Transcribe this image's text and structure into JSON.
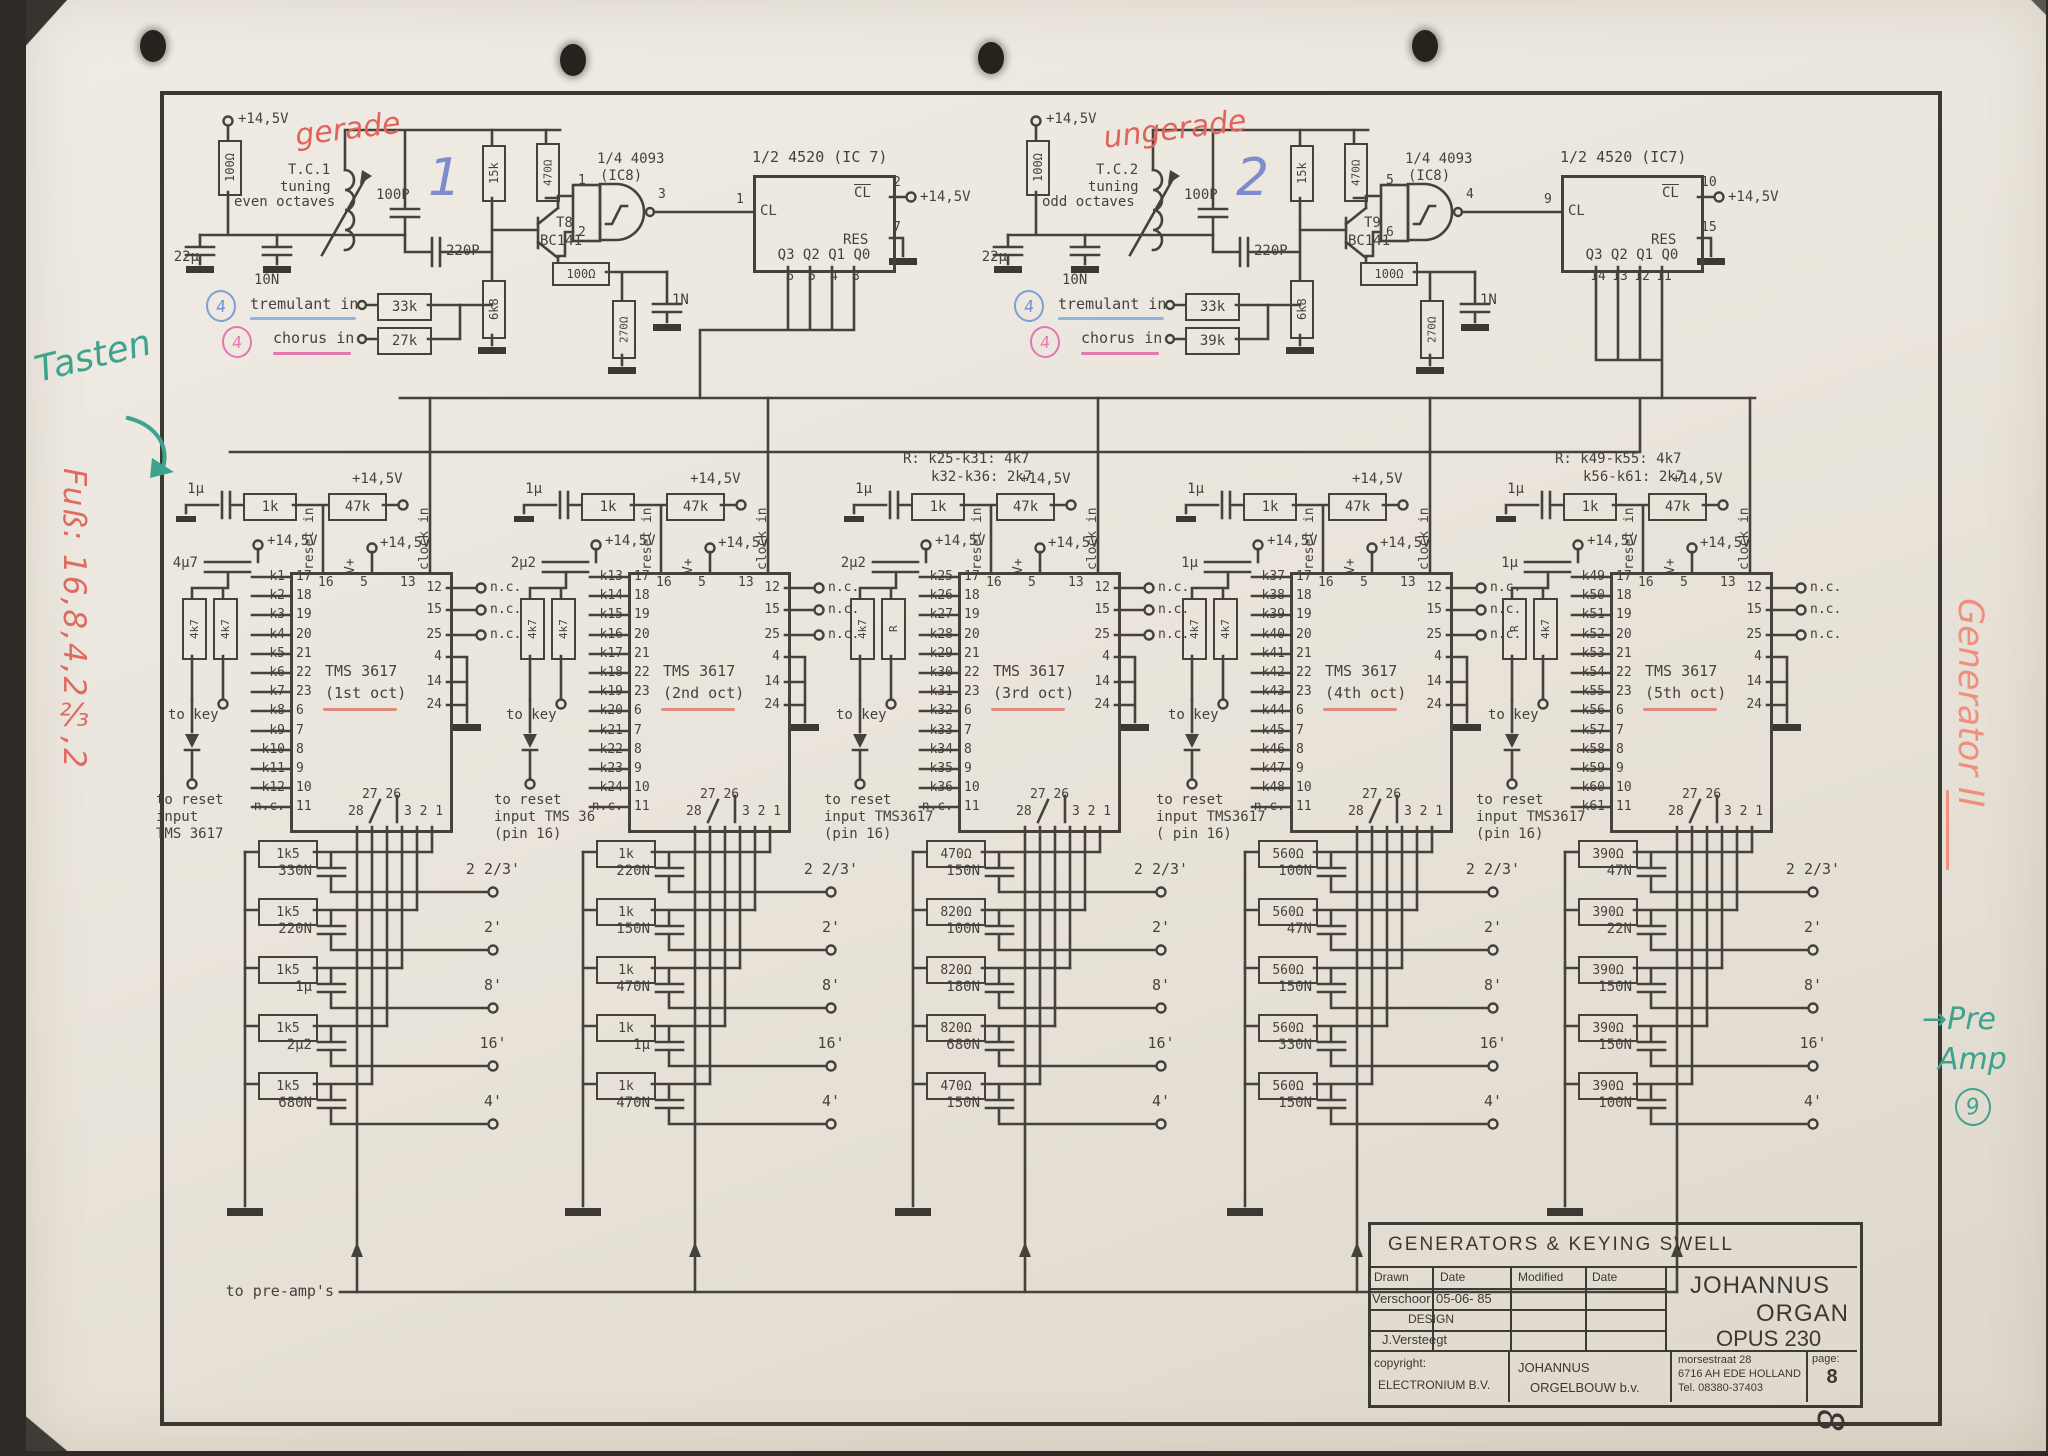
{
  "osc": [
    {
      "supply": "+14,5V",
      "r_top": "100Ω",
      "c_el": "22µ",
      "c_small": "10N",
      "tc": "T.C.1",
      "tuning_l1": "tuning",
      "tuning_l2": "even octaves",
      "hand_word": "gerade",
      "hand_num": "1",
      "c_tune": "100P",
      "c_fb": "220P",
      "r_15k": "15k",
      "r_470": "470Ω",
      "r_6k8": "6k8",
      "q_name": "T8",
      "q_type": "BC141",
      "r_100": "100Ω",
      "r_270": "270Ω",
      "c_1n": "1N",
      "gate_name": "1/4 4093",
      "gate_ic": "(IC8)",
      "gate_in1": "1",
      "gate_in2": "2",
      "gate_out": "3",
      "cnt_name": "1/2 4520 (IC 7)",
      "cnt_supply": "+14,5V",
      "cnt_cl": "CL",
      "cnt_cl_pin": "1",
      "cnt_clb": "CL",
      "cnt_clb_pin": "2",
      "cnt_res": "RES",
      "cnt_res_pin": "7",
      "cnt_q": "Q3 Q2 Q1 Q0",
      "qp": [
        "6",
        "5",
        "4",
        "3"
      ],
      "trem_badge": "4",
      "trem_label": "tremulant in",
      "trem_r": "33k",
      "chor_badge": "4",
      "chor_label": "chorus in",
      "chor_r": "27k"
    },
    {
      "supply": "+14,5V",
      "r_top": "100Ω",
      "c_el": "22µ",
      "c_small": "10N",
      "tc": "T.C.2",
      "tuning_l1": "tuning",
      "tuning_l2": "odd octaves",
      "hand_word": "ungerade",
      "hand_num": "2",
      "c_tune": "100P",
      "c_fb": "220P",
      "r_15k": "15k",
      "r_470": "470Ω",
      "r_6k8": "6k8",
      "q_name": "T9",
      "q_type": "BC141",
      "r_100": "100Ω",
      "r_270": "270Ω",
      "c_1n": "1N",
      "gate_name": "1/4 4093",
      "gate_ic": "(IC8)",
      "gate_in1": "5",
      "gate_in2": "6",
      "gate_out": "4",
      "cnt_name": "1/2 4520 (IC7)",
      "cnt_supply": "+14,5V",
      "cnt_cl": "CL",
      "cnt_cl_pin": "9",
      "cnt_clb": "CL",
      "cnt_clb_pin": "10",
      "cnt_res": "RES",
      "cnt_res_pin": "15",
      "cnt_q": "Q3 Q2 Q1 Q0",
      "qp": [
        "14",
        "13",
        "12",
        "11"
      ],
      "trem_badge": "4",
      "trem_label": "tremulant in",
      "trem_r": "33k",
      "chor_badge": "4",
      "chor_label": "chorus in",
      "chor_r": "39k"
    }
  ],
  "generators": [
    {
      "note1": "",
      "note2": "",
      "c_in": "1µ",
      "r_in": "1k",
      "r_pull": "47k",
      "supply": "+14,5V",
      "c_key": "4µ7",
      "r_key1": "4k7",
      "r_key2": "4k7",
      "reset_in": "reset in",
      "pin16": "16",
      "vplus": "V+",
      "pin5": "5",
      "clock_in": "clock in",
      "pin13": "13",
      "name": "TMS 3617",
      "oct": "(1st oct)",
      "keys": [
        {
          "k": "k1",
          "p": "17"
        },
        {
          "k": "k2",
          "p": "18"
        },
        {
          "k": "k3",
          "p": "19"
        },
        {
          "k": "k4",
          "p": "20"
        },
        {
          "k": "k5",
          "p": "21"
        },
        {
          "k": "k6",
          "p": "22"
        },
        {
          "k": "k7",
          "p": "23"
        },
        {
          "k": "k8",
          "p": "6"
        },
        {
          "k": "k9",
          "p": "7"
        },
        {
          "k": "k10",
          "p": "8"
        },
        {
          "k": "k11",
          "p": "9"
        },
        {
          "k": "k12",
          "p": "10"
        },
        {
          "k": "n.c.",
          "p": "11"
        }
      ],
      "nc": [
        {
          "p": "12",
          "t": "n.c."
        },
        {
          "p": "15",
          "t": "n.c."
        },
        {
          "p": "25",
          "t": "n.c."
        },
        {
          "p": "4",
          "t": ""
        },
        {
          "p": "14",
          "t": ""
        },
        {
          "p": "24",
          "t": ""
        }
      ],
      "bot_a": "27 26",
      "bot_b": "28",
      "bot_c": "3 2 1",
      "to_key": "to key",
      "reset_l1": "to reset",
      "reset_l2": "input",
      "reset_l3": "TMS 3617",
      "ladder": [
        {
          "r": "1k5",
          "c": "330N",
          "f": "2 2/3'"
        },
        {
          "r": "1k5",
          "c": "220N",
          "f": "2'"
        },
        {
          "r": "1k5",
          "c": "1µ",
          "f": "8'"
        },
        {
          "r": "1k5",
          "c": "2µ2",
          "f": "16'"
        },
        {
          "r": "1k5",
          "c": "680N",
          "f": "4'"
        }
      ]
    },
    {
      "note1": "",
      "note2": "",
      "c_in": "1µ",
      "r_in": "1k",
      "r_pull": "47k",
      "supply": "+14,5V",
      "c_key": "2µ2",
      "r_key1": "4k7",
      "r_key2": "4k7",
      "reset_in": "reset in",
      "pin16": "16",
      "vplus": "V+",
      "pin5": "5",
      "clock_in": "clock in",
      "pin13": "13",
      "name": "TMS 3617",
      "oct": "(2nd oct)",
      "keys": [
        {
          "k": "k13",
          "p": "17"
        },
        {
          "k": "k14",
          "p": "18"
        },
        {
          "k": "k15",
          "p": "19"
        },
        {
          "k": "k16",
          "p": "20"
        },
        {
          "k": "k17",
          "p": "21"
        },
        {
          "k": "k18",
          "p": "22"
        },
        {
          "k": "k19",
          "p": "23"
        },
        {
          "k": "k20",
          "p": "6"
        },
        {
          "k": "k21",
          "p": "7"
        },
        {
          "k": "k22",
          "p": "8"
        },
        {
          "k": "k23",
          "p": "9"
        },
        {
          "k": "k24",
          "p": "10"
        },
        {
          "k": "n.c.",
          "p": "11"
        }
      ],
      "nc": [
        {
          "p": "12",
          "t": "n.c."
        },
        {
          "p": "15",
          "t": "n.c."
        },
        {
          "p": "25",
          "t": "n.c."
        },
        {
          "p": "4",
          "t": ""
        },
        {
          "p": "14",
          "t": ""
        },
        {
          "p": "24",
          "t": ""
        }
      ],
      "bot_a": "27 26",
      "bot_b": "28",
      "bot_c": "3 2 1",
      "to_key": "to key",
      "reset_l1": "to reset",
      "reset_l2": "input TMS 36",
      "reset_l3": "(pin 16)",
      "ladder": [
        {
          "r": "1k",
          "c": "220N",
          "f": "2 2/3'"
        },
        {
          "r": "1k",
          "c": "150N",
          "f": "2'"
        },
        {
          "r": "1k",
          "c": "470N",
          "f": "8'"
        },
        {
          "r": "1k",
          "c": "1µ",
          "f": "16'"
        },
        {
          "r": "1k",
          "c": "470N",
          "f": "4'"
        }
      ]
    },
    {
      "note1": "R:  k25-k31: 4k7",
      "note2": "k32-k36: 2k7",
      "c_in": "1µ",
      "r_in": "1k",
      "r_pull": "47k",
      "supply": "+14,5V",
      "c_key": "2µ2",
      "r_key1": "4k7",
      "r_key2": "R",
      "reset_in": "reset in",
      "pin16": "16",
      "vplus": "V+",
      "pin5": "5",
      "clock_in": "clock in",
      "pin13": "13",
      "name": "TMS 3617",
      "oct": "(3rd oct)",
      "keys": [
        {
          "k": "k25",
          "p": "17"
        },
        {
          "k": "k26",
          "p": "18"
        },
        {
          "k": "k27",
          "p": "19"
        },
        {
          "k": "k28",
          "p": "20"
        },
        {
          "k": "k29",
          "p": "21"
        },
        {
          "k": "k30",
          "p": "22"
        },
        {
          "k": "k31",
          "p": "23"
        },
        {
          "k": "k32",
          "p": "6"
        },
        {
          "k": "k33",
          "p": "7"
        },
        {
          "k": "k34",
          "p": "8"
        },
        {
          "k": "k35",
          "p": "9"
        },
        {
          "k": "k36",
          "p": "10"
        },
        {
          "k": "n.c.",
          "p": "11"
        }
      ],
      "nc": [
        {
          "p": "12",
          "t": "n.c."
        },
        {
          "p": "15",
          "t": "n.c."
        },
        {
          "p": "25",
          "t": "n.c."
        },
        {
          "p": "4",
          "t": ""
        },
        {
          "p": "14",
          "t": ""
        },
        {
          "p": "24",
          "t": ""
        }
      ],
      "bot_a": "27 26",
      "bot_b": "28",
      "bot_c": "3 2 1",
      "to_key": "to key",
      "reset_l1": "to reset",
      "reset_l2": "input TMS3617",
      "reset_l3": "(pin 16)",
      "ladder": [
        {
          "r": "470Ω",
          "c": "150N",
          "f": "2 2/3'"
        },
        {
          "r": "820Ω",
          "c": "100N",
          "f": "2'"
        },
        {
          "r": "820Ω",
          "c": "180N",
          "f": "8'"
        },
        {
          "r": "820Ω",
          "c": "680N",
          "f": "16'"
        },
        {
          "r": "470Ω",
          "c": "150N",
          "f": "4'"
        }
      ]
    },
    {
      "note1": "",
      "note2": "",
      "c_in": "1µ",
      "r_in": "1k",
      "r_pull": "47k",
      "supply": "+14,5V",
      "c_key": "1µ",
      "r_key1": "4k7",
      "r_key2": "4k7",
      "reset_in": "reset in",
      "pin16": "16",
      "vplus": "V+",
      "pin5": "5",
      "clock_in": "clock in",
      "pin13": "13",
      "name": "TMS 3617",
      "oct": "(4th oct)",
      "keys": [
        {
          "k": "k37",
          "p": "17"
        },
        {
          "k": "k38",
          "p": "18"
        },
        {
          "k": "k39",
          "p": "19"
        },
        {
          "k": "k40",
          "p": "20"
        },
        {
          "k": "k41",
          "p": "21"
        },
        {
          "k": "k42",
          "p": "22"
        },
        {
          "k": "k43",
          "p": "23"
        },
        {
          "k": "k44",
          "p": "6"
        },
        {
          "k": "k45",
          "p": "7"
        },
        {
          "k": "k46",
          "p": "8"
        },
        {
          "k": "k47",
          "p": "9"
        },
        {
          "k": "k48",
          "p": "10"
        },
        {
          "k": "n.c.",
          "p": "11"
        }
      ],
      "nc": [
        {
          "p": "12",
          "t": "n.c."
        },
        {
          "p": "15",
          "t": "n.c."
        },
        {
          "p": "25",
          "t": "n.c."
        },
        {
          "p": "4",
          "t": ""
        },
        {
          "p": "14",
          "t": ""
        },
        {
          "p": "24",
          "t": ""
        }
      ],
      "bot_a": "27 26",
      "bot_b": "28",
      "bot_c": "3 2 1",
      "to_key": "to key",
      "reset_l1": "to reset",
      "reset_l2": "input TMS3617",
      "reset_l3": "( pin 16)",
      "ladder": [
        {
          "r": "560Ω",
          "c": "100N",
          "f": "2 2/3'"
        },
        {
          "r": "560Ω",
          "c": "47N",
          "f": "2'"
        },
        {
          "r": "560Ω",
          "c": "150N",
          "f": "8'"
        },
        {
          "r": "560Ω",
          "c": "330N",
          "f": "16'"
        },
        {
          "r": "560Ω",
          "c": "150N",
          "f": "4'"
        }
      ]
    },
    {
      "note1": "R: k49-k55: 4k7",
      "note2": "k56-k61: 2k7",
      "c_in": "1µ",
      "r_in": "1k",
      "r_pull": "47k",
      "supply": "+14,5V",
      "c_key": "1µ",
      "r_key1": "R",
      "r_key2": "4k7",
      "reset_in": "reset in",
      "pin16": "16",
      "vplus": "V+",
      "pin5": "5",
      "clock_in": "clock in",
      "pin13": "13",
      "name": "TMS 3617",
      "oct": "(5th oct)",
      "keys": [
        {
          "k": "k49",
          "p": "17"
        },
        {
          "k": "k50",
          "p": "18"
        },
        {
          "k": "k51",
          "p": "19"
        },
        {
          "k": "k52",
          "p": "20"
        },
        {
          "k": "k53",
          "p": "21"
        },
        {
          "k": "k54",
          "p": "22"
        },
        {
          "k": "k55",
          "p": "23"
        },
        {
          "k": "k56",
          "p": "6"
        },
        {
          "k": "k57",
          "p": "7"
        },
        {
          "k": "k58",
          "p": "8"
        },
        {
          "k": "k59",
          "p": "9"
        },
        {
          "k": "k60",
          "p": "10"
        },
        {
          "k": "k61",
          "p": "11"
        }
      ],
      "nc": [
        {
          "p": "12",
          "t": "n.c."
        },
        {
          "p": "15",
          "t": "n.c."
        },
        {
          "p": "25",
          "t": "n.c."
        },
        {
          "p": "4",
          "t": ""
        },
        {
          "p": "14",
          "t": ""
        },
        {
          "p": "24",
          "t": ""
        }
      ],
      "bot_a": "27 26",
      "bot_b": "28",
      "bot_c": "3 2 1",
      "to_key": "to key",
      "reset_l1": "to reset",
      "reset_l2": "input TMS3617",
      "reset_l3": "(pin 16)",
      "ladder": [
        {
          "r": "390Ω",
          "c": "47N",
          "f": "2 2/3'"
        },
        {
          "r": "390Ω",
          "c": "22N",
          "f": "2'"
        },
        {
          "r": "390Ω",
          "c": "150N",
          "f": "8'"
        },
        {
          "r": "390Ω",
          "c": "150N",
          "f": "16'"
        },
        {
          "r": "390Ω",
          "c": "100N",
          "f": "4'"
        }
      ]
    }
  ],
  "buses": {
    "preamp": "to pre-amp's"
  },
  "titleblock": {
    "title": "GENERATORS  &  KEYING  SWELL",
    "h_drawn": "Drawn",
    "h_date1": "Date",
    "h_modified": "Modified",
    "h_date2": "Date",
    "drawn_name": "Verschoor",
    "drawn_date": "05-06- 85",
    "design": "DESIGN",
    "designer": "J.Versteegt",
    "brand1": "JOHANNUS",
    "brand2": "ORGAN",
    "brand3": "OPUS  230",
    "copyright1": "copyright:",
    "copyright2": "ELECTRONIUM  B.V.",
    "firm1": "JOHANNUS",
    "firm2": "ORGELBOUW b.v.",
    "addr1": "morsestraat 28",
    "addr2": "6716 AH EDE HOLLAND",
    "addr3": "Tel. 08380-37403",
    "page_label": "page:",
    "page_num": "8"
  },
  "margin": {
    "tasten": "Tasten",
    "fuss": "Fuß: 16,8,4,2⅔,2",
    "generator": "Generator II",
    "pre1": "→Pre",
    "pre2": "Amp",
    "pre3": "9",
    "hand8": "8"
  }
}
